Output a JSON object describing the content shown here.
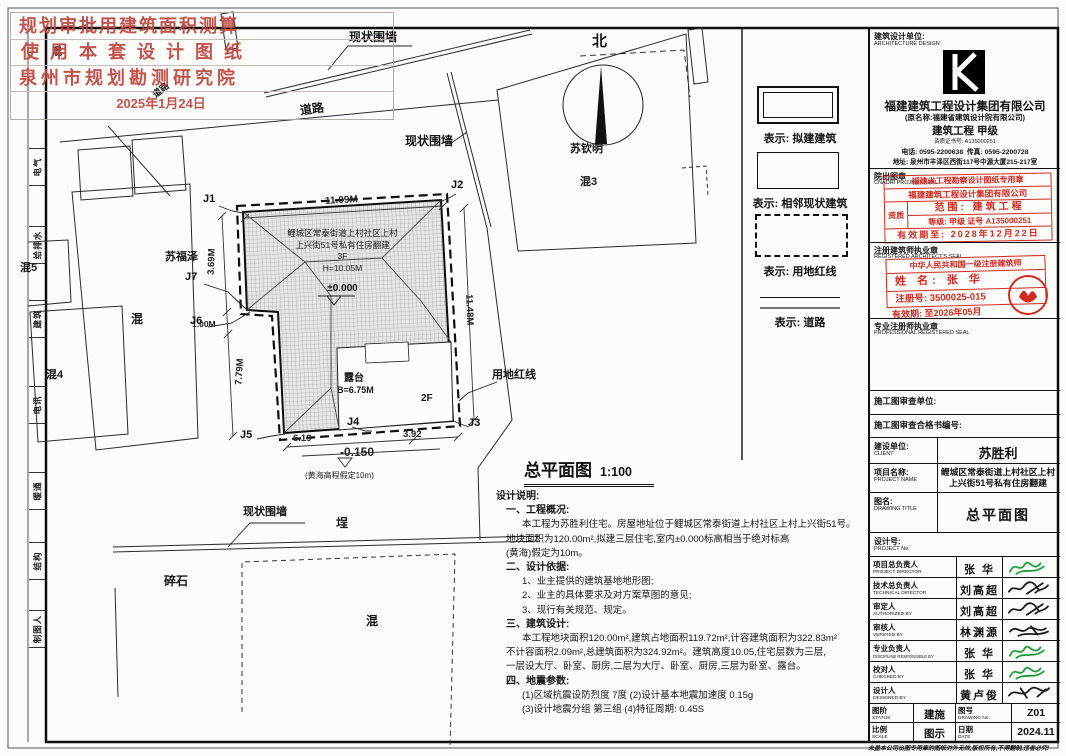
{
  "approval_stamp": {
    "line1": "规划审批用建筑面积测算",
    "line2": "使用本套设计图纸",
    "line3": "泉州市规划勘测研究院",
    "date": "2025年1月24日"
  },
  "strip": {
    "cells": [
      "电气",
      "给排水",
      "建筑",
      "电讯",
      "暖通",
      "结构",
      "制图人"
    ]
  },
  "plan": {
    "title": "总平面图",
    "scale": "1:100",
    "north": "北",
    "labels": {
      "wall_top": "现状围墙",
      "wall_right": "现状围墙",
      "wall_bottom": "现状围墙",
      "road_main": "道路",
      "road_small": "道路",
      "su_qinming": "苏钦明",
      "hun3": "混3",
      "su_fuze": "苏福泽",
      "hun_left": "混",
      "hun4": "混4",
      "hun5": "混5",
      "hun_tl": "混",
      "cheng": "埕",
      "suishi": "碎石",
      "hun_bottom": "混",
      "terrace": "露台",
      "terrace_height": "B=6.75M",
      "floor": "2F",
      "redline": "用地红线"
    },
    "building": {
      "line1": "鲤城区常泰街道上村社区上村",
      "line2": "上兴街51号私有住房翻建",
      "line3": "3F",
      "line4": "H=10.05M",
      "level": "±0.000"
    },
    "dims": {
      "top": "11.09M",
      "right": "11.48M",
      "left_upper": "3.69M",
      "left_step": "1.00M",
      "left_lower": "7.79M",
      "bottom_left": "6.19",
      "bottom_right": "3.92",
      "level": "-0.150",
      "level_note": "(黄海高程假定10m)"
    },
    "corners": [
      "J1",
      "J2",
      "J3",
      "J4",
      "J5",
      "J6",
      "J7"
    ]
  },
  "legend": {
    "proposed": "表示: 拟建建筑",
    "existing": "表示: 相邻现状建筑",
    "redline": "表示: 用地红线",
    "road": "表示: 道路"
  },
  "notes": {
    "lines": [
      "设计说明:",
      "一、工程概况:",
      "本工程为苏胜利住宅。房屋地址位于鲤城区常泰街道上村社区上村上兴街51号。",
      "地块面积为120.00m²,拟建三层住宅,室内±0.000标高相当于绝对标高",
      "(黄海)假定为10m。",
      "二、设计依据:",
      "1、业主提供的建筑基地地形图;",
      "2、业主的具体要求及对方案草图的意见;",
      "3、现行有关规范、规定。",
      "三、建筑设计:",
      "本工程地块面积120.00m²,建筑占地面积119.72m²,计容建筑面积为322.83m²",
      "不计容面积2.09m²,总建筑面积为324.92m²。建筑高度10.05,住宅层数为三层,",
      "一层设大厅、卧室、厨房,二层为大厅、卧室、厨房,三层为卧室、露台。",
      "四、地震参数:",
      "(1)区域抗震设防烈度 7度 (2)设计基本地震加速度 0.15g",
      "(3)设计地震分组 第三组 (4)特征周期: 0.45S"
    ]
  },
  "titleblock": {
    "design_unit": {
      "label": "建筑设计单位:",
      "label_en": "ARCHITECTURE DESIGN",
      "company": "福建建筑工程设计集团有限公司",
      "former_name": "(原名称:福建省建筑设计院有限公司)",
      "grade": "建筑工程 甲级",
      "cert_no": "资质证书号: A135000251",
      "phone": "电话: 0595-2200638",
      "fax": "传真: 0595-2200728",
      "address": "地址: 泉州市丰泽区西街117号中源大厦215-217室"
    },
    "project_seal": {
      "label": "院出图章",
      "label_en": "CNADRI PROJECT SEAL",
      "stamp_title": "福建省工程勘察设计图纸专用章",
      "stamp_company": "福建建筑工程设计集团有限公司",
      "stamp_zizhi": "资质",
      "stamp_scope": "范围: 建筑工程",
      "stamp_grade": "等级: 甲级 证号 A135000251",
      "stamp_valid": "有效期至: 2028年12月22日"
    },
    "architect_seal": {
      "label": "注册建筑师执业章",
      "label_en": "REGISTERED ARCHITECT'S SEAL",
      "stamp_title": "中华人民共和国一级注册建筑师",
      "name": "姓 名: 张 华",
      "reg_no": "注册号: 3500025-015",
      "valid": "有效期: 至2026年05月"
    },
    "professional_seal": {
      "label": "专业注册师执业章",
      "label_en": "PROFESSIONAL REGISTERED SEAL"
    },
    "review_unit": "施工图审查单位:",
    "review_no": "施工图审查合格书编号:",
    "client": {
      "label": "建设单位:",
      "label_en": "CLIENT",
      "value": "苏胜利"
    },
    "project": {
      "label": "项目名称:",
      "label_en": "PROJECT NAME",
      "value1": "鲤城区常泰街道上村社区上村",
      "value2": "上兴街51号私有住房翻建"
    },
    "drawing": {
      "label": "图名:",
      "label_en": "DRAWING TITLE",
      "value": "总平面图"
    },
    "project_no": {
      "label": "设计号:",
      "label_en": "PROJECT No."
    },
    "people": [
      {
        "label": "项目总负责人",
        "en": "PROJECT DIRECTOR",
        "name": "张 华"
      },
      {
        "label": "技术总负责人",
        "en": "TECHNICAL DIRECTOR",
        "name": "刘高超"
      },
      {
        "label": "审定人",
        "en": "AUTHORIZED BY",
        "name": "刘高超"
      },
      {
        "label": "审核人",
        "en": "VERIFIED BY",
        "name": "林渊源"
      },
      {
        "label": "专业负责人",
        "en": "DISCIPLINE RESPONSIBLE BY",
        "name": "张 华"
      },
      {
        "label": "校对人",
        "en": "CHECKED BY",
        "name": "张 华"
      },
      {
        "label": "设计人",
        "en": "DESIGNED BY",
        "name": "黄卢俊"
      }
    ],
    "status": {
      "label": "图阶",
      "label_en": "STATUS",
      "value": "建施"
    },
    "drawing_no": {
      "label": "图号",
      "label_en": "DRAWING No.",
      "value": "Z01"
    },
    "scale": {
      "label": "比例",
      "label_en": "SCALE",
      "value": "图示"
    },
    "date": {
      "label": "日期",
      "label_en": "DATE",
      "value": "2024.11"
    },
    "footer": "未盖本公司出图专用章的图纸对外无效,版权所有,不得翻制,违者必究!"
  },
  "colors": {
    "stamp_red": "#bf4740",
    "seal_red": "#d42a20",
    "signature_green": "#1e9e3e"
  }
}
